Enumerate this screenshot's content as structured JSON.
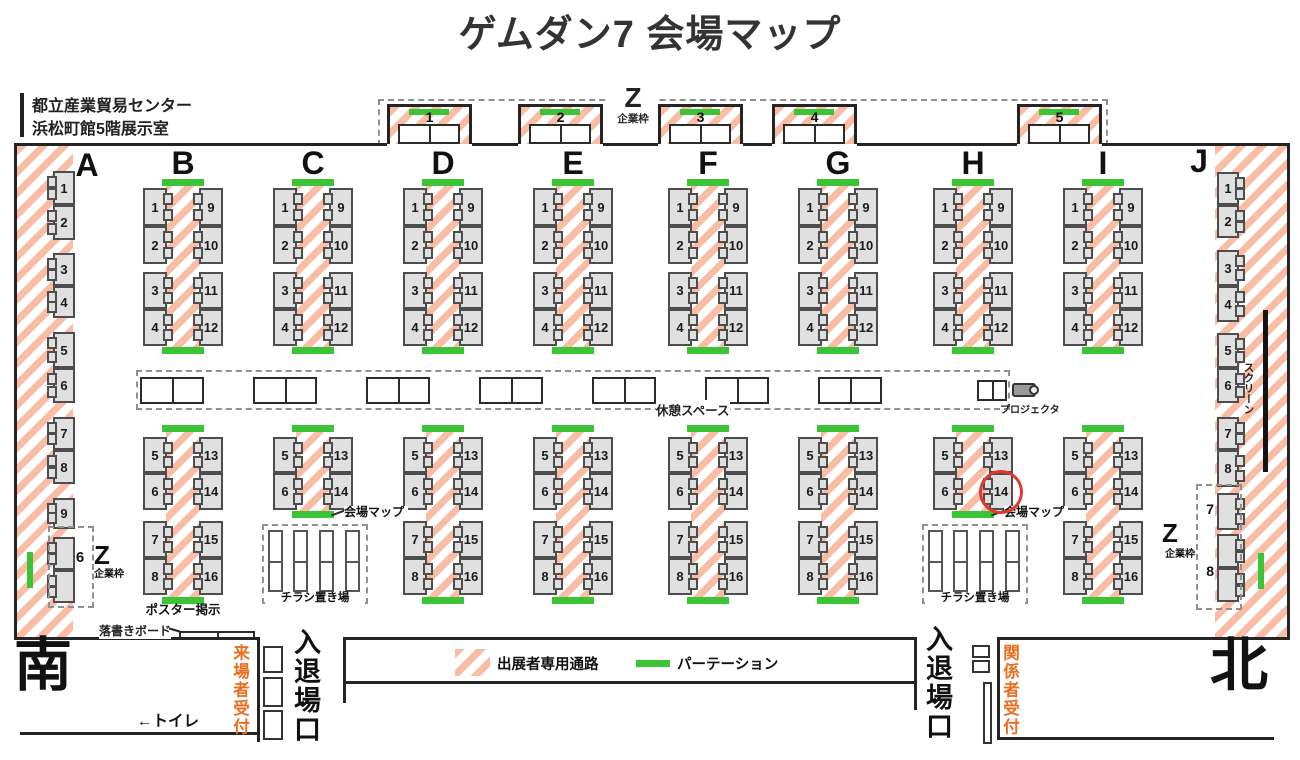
{
  "title": "ゲムダン7 会場マップ",
  "venue": {
    "line1": "都立産業貿易センター",
    "line2": "浜松町館5階展示室"
  },
  "legend": {
    "passage_label": "出展者専用通路",
    "partition_label": "パーテーション"
  },
  "labels": {
    "z": "Z",
    "corporate": "企業枠",
    "rest_space": "休憩スペース",
    "projector": "プロジェクタ",
    "screen": "スクリーン",
    "venue_map": "会場マップ",
    "flyer_area": "チラシ置き場",
    "poster_area": "ポスター掲示",
    "graffiti_board": "落書きボード",
    "toilet": "←トイレ",
    "south": "南",
    "north": "北",
    "entrance": "入退場口",
    "visitor_reception": "来場者受付",
    "staff_reception": "関係者受付"
  },
  "z_top": {
    "booths": [
      "1",
      "2",
      "3",
      "4",
      "5"
    ]
  },
  "side_columns": {
    "A": {
      "letter": "A",
      "booths": [
        "1",
        "2",
        "3",
        "4",
        "5",
        "6",
        "7",
        "8",
        "9"
      ],
      "z_booth": "6"
    },
    "J": {
      "letter": "J",
      "booths": [
        "1",
        "2",
        "3",
        "4",
        "5",
        "6",
        "7",
        "8"
      ],
      "z_booths": [
        "7",
        "8"
      ]
    }
  },
  "pair_columns": [
    {
      "letter": "B",
      "upper_left": [
        "1",
        "2",
        "3",
        "4"
      ],
      "upper_right": [
        "9",
        "10",
        "11",
        "12"
      ],
      "lower_left": [
        "5",
        "6",
        "7",
        "8"
      ],
      "lower_right": [
        "13",
        "14",
        "15",
        "16"
      ],
      "lower": "full",
      "poster_caption": true
    },
    {
      "letter": "C",
      "upper_left": [
        "1",
        "2",
        "3",
        "4"
      ],
      "upper_right": [
        "9",
        "10",
        "11",
        "12"
      ],
      "lower_left": [
        "5",
        "6"
      ],
      "lower_right": [
        "13",
        "14"
      ],
      "lower": "short",
      "map_label": true,
      "flyer_area": true
    },
    {
      "letter": "D",
      "upper_left": [
        "1",
        "2",
        "3",
        "4"
      ],
      "upper_right": [
        "9",
        "10",
        "11",
        "12"
      ],
      "lower_left": [
        "5",
        "6",
        "7",
        "8"
      ],
      "lower_right": [
        "13",
        "14",
        "15",
        "16"
      ],
      "lower": "full"
    },
    {
      "letter": "E",
      "upper_left": [
        "1",
        "2",
        "3",
        "4"
      ],
      "upper_right": [
        "9",
        "10",
        "11",
        "12"
      ],
      "lower_left": [
        "5",
        "6",
        "7",
        "8"
      ],
      "lower_right": [
        "13",
        "14",
        "15",
        "16"
      ],
      "lower": "full"
    },
    {
      "letter": "F",
      "upper_left": [
        "1",
        "2",
        "3",
        "4"
      ],
      "upper_right": [
        "9",
        "10",
        "11",
        "12"
      ],
      "lower_left": [
        "5",
        "6",
        "7",
        "8"
      ],
      "lower_right": [
        "13",
        "14",
        "15",
        "16"
      ],
      "lower": "full"
    },
    {
      "letter": "G",
      "upper_left": [
        "1",
        "2",
        "3",
        "4"
      ],
      "upper_right": [
        "9",
        "10",
        "11",
        "12"
      ],
      "lower_left": [
        "5",
        "6",
        "7",
        "8"
      ],
      "lower_right": [
        "13",
        "14",
        "15",
        "16"
      ],
      "lower": "full"
    },
    {
      "letter": "H",
      "upper_left": [
        "1",
        "2",
        "3",
        "4"
      ],
      "upper_right": [
        "9",
        "10",
        "11",
        "12"
      ],
      "lower_left": [
        "5",
        "6"
      ],
      "lower_right": [
        "13",
        "14"
      ],
      "lower": "short",
      "map_label": true,
      "flyer_area": true,
      "highlight_booth": "14"
    },
    {
      "letter": "I",
      "upper_left": [
        "1",
        "2",
        "3",
        "4"
      ],
      "upper_right": [
        "9",
        "10",
        "11",
        "12"
      ],
      "lower_left": [
        "5",
        "6",
        "7",
        "8"
      ],
      "lower_right": [
        "13",
        "14",
        "15",
        "16"
      ],
      "lower": "full"
    }
  ],
  "highlight": {
    "column": "H",
    "booth": "14"
  },
  "colors": {
    "hatch": "#f9bca4",
    "partition_green": "#3cc437",
    "reception_text": "#ed6d1f",
    "highlight_red": "#e6352c",
    "wall": "#242424"
  }
}
